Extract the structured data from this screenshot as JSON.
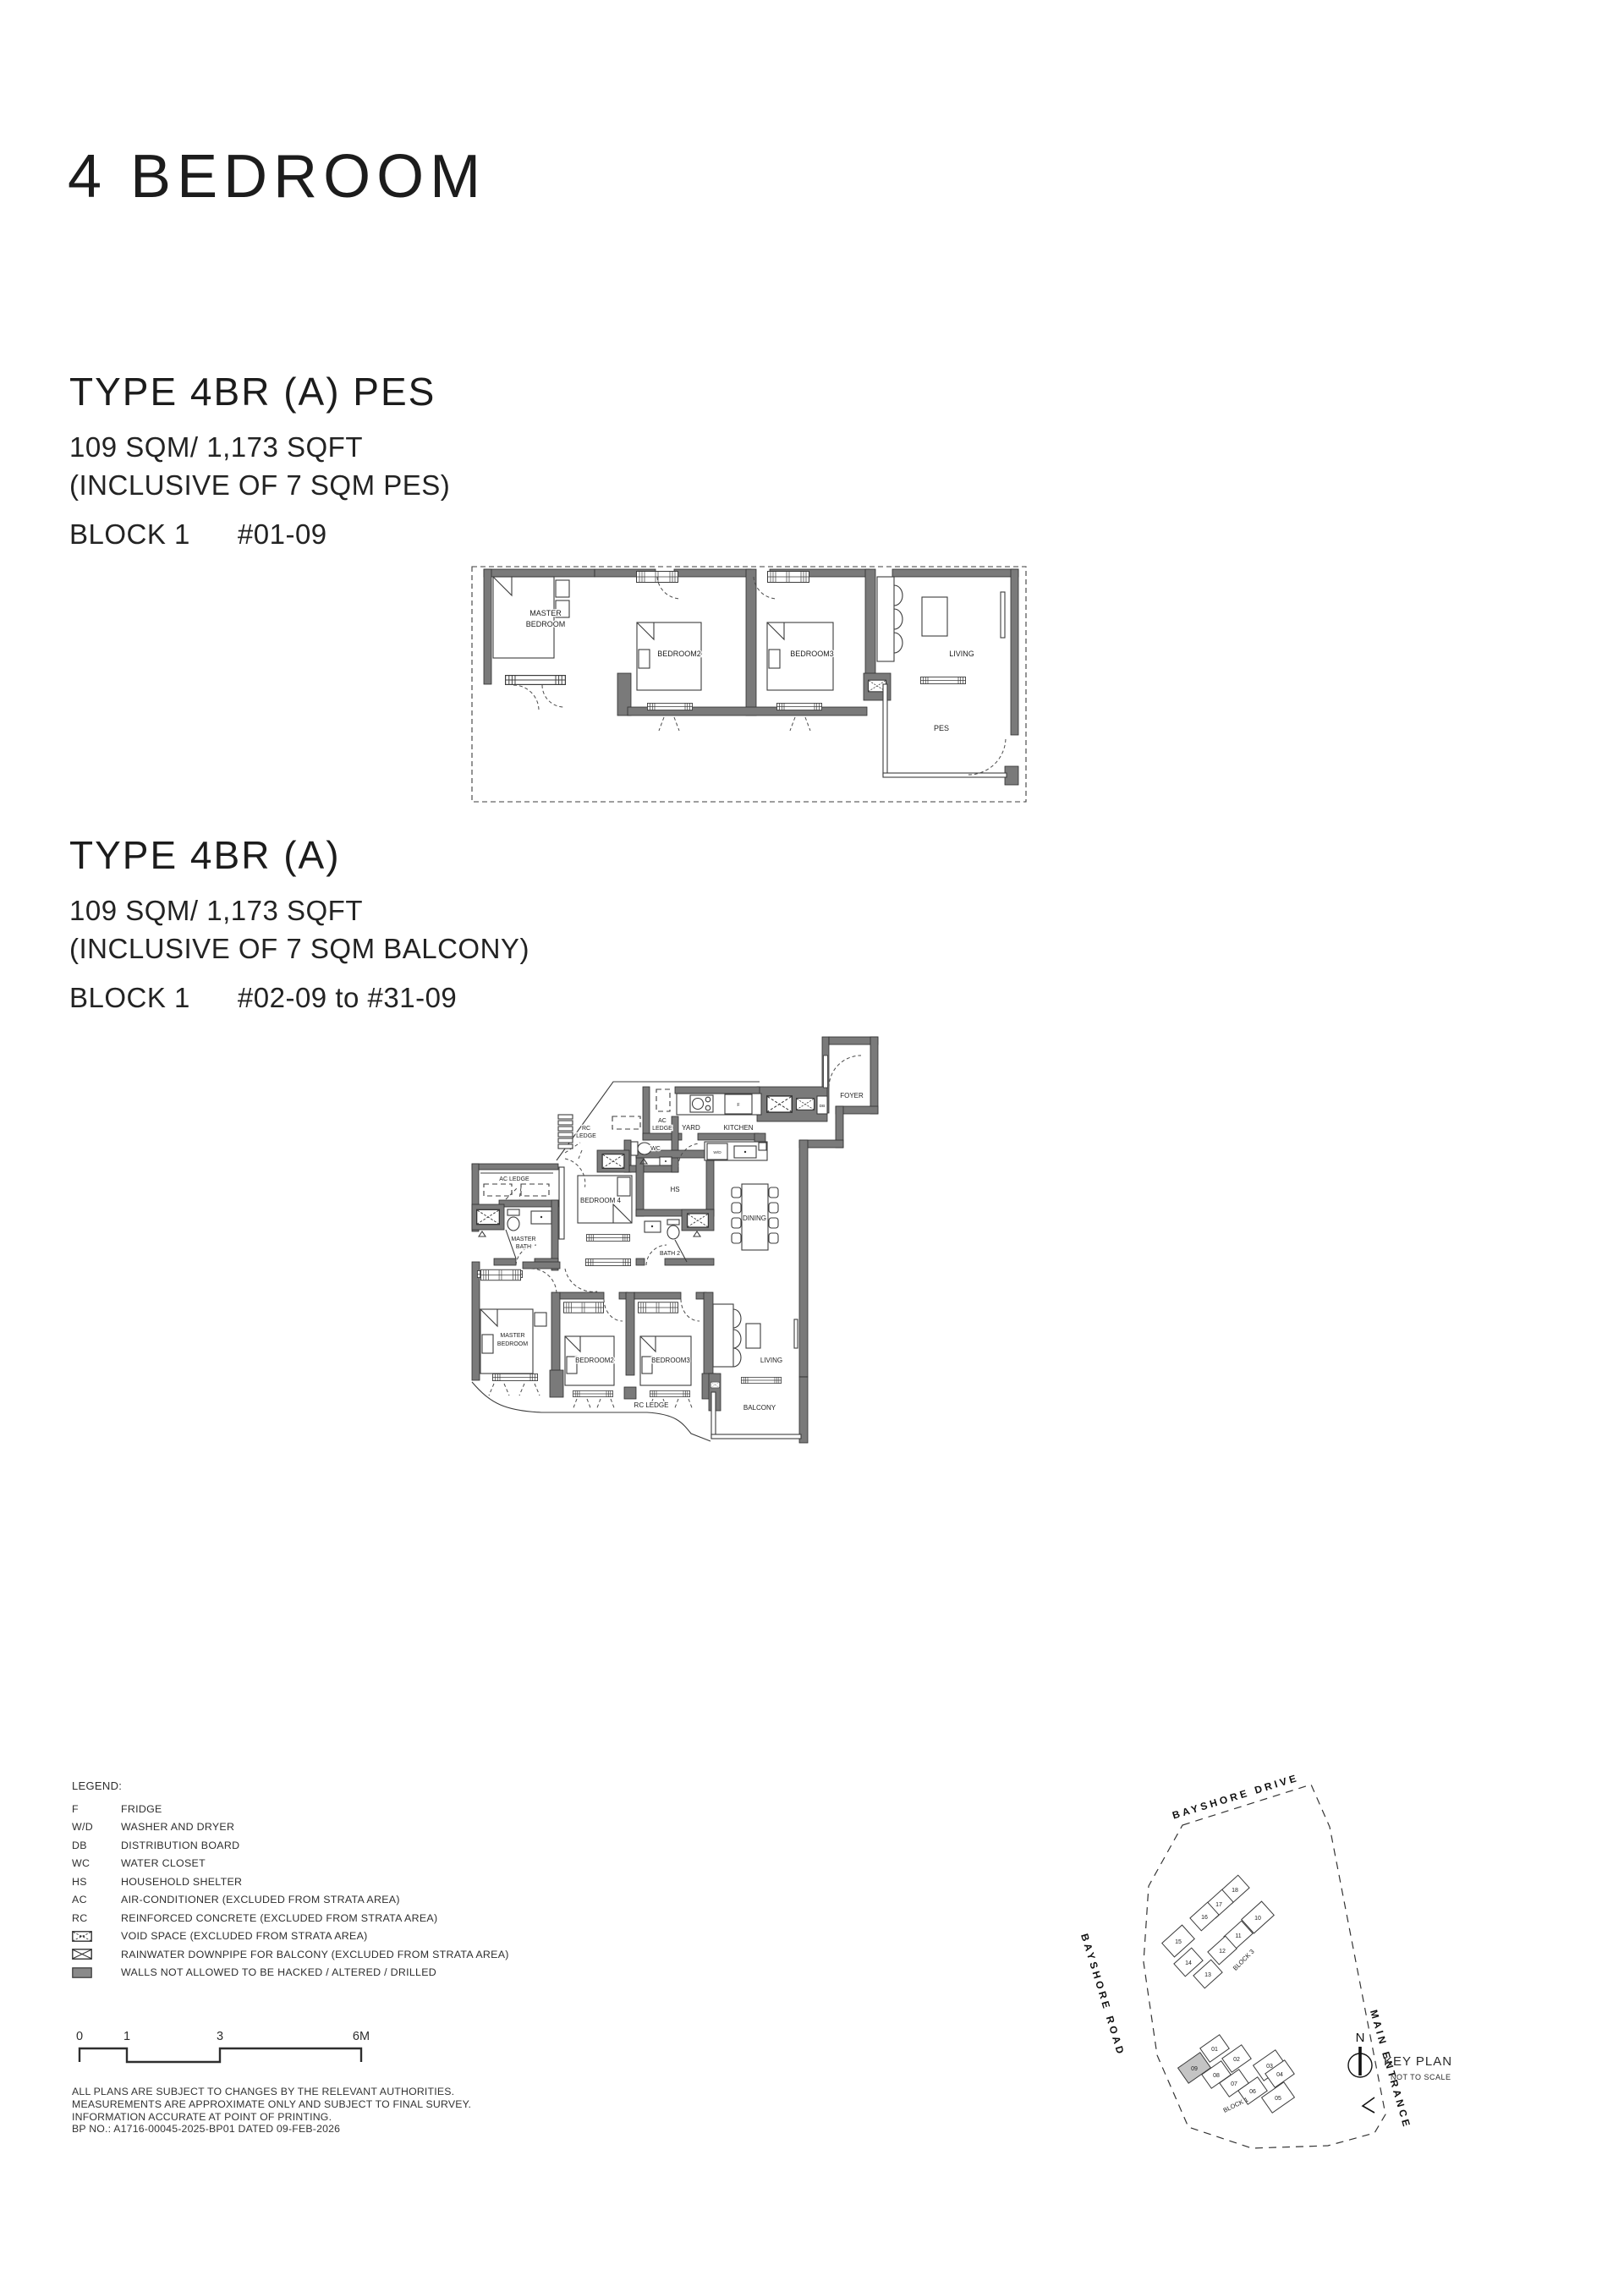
{
  "page_title": "4 BEDROOM",
  "sections": [
    {
      "heading": "TYPE 4BR (A) PES",
      "area": "109 SQM/ 1,173 SQFT",
      "inclusive": "(INCLUSIVE OF 7 SQM PES)",
      "block": "BLOCK 1",
      "units": "#01-09"
    },
    {
      "heading": "TYPE 4BR (A)",
      "area": "109 SQM/ 1,173 SQFT",
      "inclusive": "(INCLUSIVE OF 7 SQM BALCONY)",
      "block": "BLOCK 1",
      "units": "#02-09 to #31-09"
    }
  ],
  "plan_small": {
    "master_1": "MASTER",
    "master_2": "BEDROOM",
    "bedroom2": "BEDROOM2",
    "bedroom3": "BEDROOM3",
    "living": "LIVING",
    "pes": "PES"
  },
  "plan_main": {
    "foyer": "FOYER",
    "rc_ledge_1": "RC",
    "rc_ledge_2": "LEDGE",
    "ac_ledge_top_1": "AC",
    "ac_ledge_top_2": "LEDGE",
    "yard": "YARD",
    "kitchen": "KITCHEN",
    "wc": "WC",
    "fridge": "F",
    "washer_dryer": "W/D",
    "db": "DB",
    "hs": "HS",
    "dining": "DINING",
    "ac_ledge_left": "AC LEDGE",
    "master_bath_1": "MASTER",
    "master_bath_2": "BATH",
    "bedroom4": "BEDROOM 4",
    "bath2": "BATH 2",
    "master_1": "MASTER",
    "master_2": "BEDROOM",
    "bedroom2": "BEDROOM2",
    "bedroom3": "BEDROOM3",
    "living": "LIVING",
    "rc_ledge_bottom": "RC LEDGE",
    "balcony": "BALCONY"
  },
  "legend": {
    "title": "LEGEND:",
    "items": [
      {
        "code": "F",
        "desc": "FRIDGE"
      },
      {
        "code": "W/D",
        "desc": "WASHER AND DRYER"
      },
      {
        "code": "DB",
        "desc": "DISTRIBUTION BOARD"
      },
      {
        "code": "WC",
        "desc": "WATER CLOSET"
      },
      {
        "code": "HS",
        "desc": "HOUSEHOLD SHELTER"
      },
      {
        "code": "AC",
        "desc": "AIR-CONDITIONER (EXCLUDED FROM STRATA AREA)"
      },
      {
        "code": "RC",
        "desc": "REINFORCED CONCRETE (EXCLUDED FROM STRATA AREA)"
      }
    ],
    "icon_items": [
      {
        "icon": "void-space-icon",
        "desc": "VOID SPACE (EXCLUDED FROM STRATA AREA)"
      },
      {
        "icon": "rainwater-downpipe-icon",
        "desc": "RAINWATER DOWNPIPE FOR BALCONY (EXCLUDED FROM STRATA AREA)"
      },
      {
        "icon": "hatched-wall-icon",
        "desc": "WALLS NOT ALLOWED TO BE HACKED / ALTERED / DRILLED"
      }
    ]
  },
  "scale_bar": {
    "ticks": [
      "0",
      "1",
      "3",
      "6M"
    ]
  },
  "footnotes": [
    "ALL PLANS ARE SUBJECT TO CHANGES BY THE RELEVANT AUTHORITIES.",
    "MEASUREMENTS ARE APPROXIMATE ONLY AND SUBJECT TO FINAL SURVEY.",
    "INFORMATION ACCURATE AT POINT OF PRINTING.",
    "BP NO.: A1716-00045-2025-BP01  DATED 09-FEB-2026"
  ],
  "key_plan": {
    "street_top": "BAYSHORE DRIVE",
    "street_left": "BAYSHORE ROAD",
    "street_right": "MAIN ENTRANCE",
    "north": "N",
    "title": "KEY PLAN",
    "subtitle": "NOT TO SCALE",
    "block3_label": "BLOCK 3",
    "block1_label": "BLOCK 1",
    "block3_units": [
      "18",
      "17",
      "16",
      "10",
      "11",
      "15",
      "12",
      "14",
      "13"
    ],
    "block1_units": [
      "01",
      "02",
      "03",
      "04",
      "05",
      "06",
      "07",
      "08",
      "09"
    ],
    "highlighted_unit": "09"
  },
  "colors": {
    "wall": "#7a7a7a",
    "highlight": "#c4c4c4",
    "line": "#3c3c3c"
  }
}
